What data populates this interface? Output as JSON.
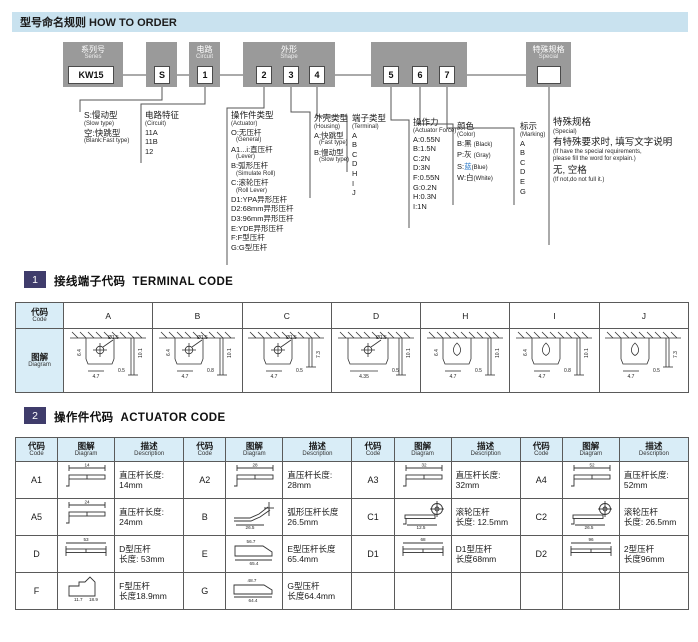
{
  "page": {
    "title": "型号命名规则 HOW TO ORDER"
  },
  "colors": {
    "header_bg": "#c9e2ef",
    "box_gray": "#9a9a9a",
    "table_header_bg": "#d9edf7",
    "badge_bg": "#3f3c6b",
    "line_color": "#555555",
    "blue": "#2878c8"
  },
  "flow": {
    "groups": [
      {
        "key": "series",
        "label_cn": "系列号",
        "label_en": "Series",
        "codes": [
          "KW15"
        ]
      },
      {
        "key": "speed",
        "label_cn": "",
        "label_en": "",
        "codes": [
          "S"
        ]
      },
      {
        "key": "circuit",
        "label_cn": "电路",
        "label_en": "Circuit",
        "codes": [
          "1"
        ]
      },
      {
        "key": "shape",
        "label_cn": "外形",
        "label_en": "Shape",
        "codes": [
          "2",
          "3",
          "4"
        ]
      },
      {
        "key": "force",
        "label_cn": "",
        "label_en": "",
        "codes": [
          "5",
          "6",
          "7"
        ]
      },
      {
        "key": "special",
        "label_cn": "特殊规格",
        "label_en": "Special",
        "codes": [
          ""
        ]
      }
    ],
    "spec_columns": [
      {
        "name": "speed-type",
        "lines": [
          {
            "t": "S:慢动型",
            "s": "cn"
          },
          {
            "t": "(Slow type)",
            "s": "en"
          },
          {
            "t": "空:快跳型",
            "s": "cn"
          },
          {
            "t": "(Blank:Fast type)",
            "s": "en"
          }
        ]
      },
      {
        "name": "circuit-feature",
        "lines": [
          {
            "t": "电路特征",
            "s": "cn"
          },
          {
            "t": "(Circuit)",
            "s": "en"
          },
          {
            "t": "11A",
            "s": "item"
          },
          {
            "t": "11B",
            "s": "item"
          },
          {
            "t": "12",
            "s": "item"
          }
        ]
      },
      {
        "name": "actuator-type",
        "lines": [
          {
            "t": "操作件类型",
            "s": "cn"
          },
          {
            "t": "(Actuator)",
            "s": "en"
          },
          {
            "t": "O:无压杆",
            "s": "item"
          },
          {
            "t": "(General)",
            "s": "en-ind"
          },
          {
            "t": "A1...i:直压杆",
            "s": "item"
          },
          {
            "t": "(Lever)",
            "s": "en-ind"
          },
          {
            "t": "B:弧形压杆",
            "s": "item"
          },
          {
            "t": "(Simulate Roll)",
            "s": "en-ind"
          },
          {
            "t": "C:滚轮压杆",
            "s": "item"
          },
          {
            "t": "(Roll Lever)",
            "s": "en-ind"
          },
          {
            "t": "D1:YPA异形压杆",
            "s": "item"
          },
          {
            "t": "D2:68mm异形压杆",
            "s": "item"
          },
          {
            "t": "D3:96mm异形压杆",
            "s": "item"
          },
          {
            "t": "E:YDE异形压杆",
            "s": "item"
          },
          {
            "t": "F:F型压杆",
            "s": "item"
          },
          {
            "t": "G:G型压杆",
            "s": "item"
          }
        ]
      },
      {
        "name": "housing-type",
        "lines": [
          {
            "t": "外壳类型",
            "s": "cn"
          },
          {
            "t": "(Housing)",
            "s": "en"
          },
          {
            "t": "A:快跳型",
            "s": "item"
          },
          {
            "t": "(Fast type)",
            "s": "en-ind"
          },
          {
            "t": "B:慢动型",
            "s": "item"
          },
          {
            "t": "(Slow type)",
            "s": "en-ind"
          }
        ]
      },
      {
        "name": "terminal-type",
        "lines": [
          {
            "t": "端子类型",
            "s": "cn"
          },
          {
            "t": "(Terminal)",
            "s": "en"
          },
          {
            "t": "A",
            "s": "item"
          },
          {
            "t": "B",
            "s": "item"
          },
          {
            "t": "C",
            "s": "item"
          },
          {
            "t": "D",
            "s": "item"
          },
          {
            "t": "H",
            "s": "item"
          },
          {
            "t": "I",
            "s": "item"
          },
          {
            "t": "J",
            "s": "item"
          }
        ]
      },
      {
        "name": "actuator-force",
        "lines": [
          {
            "t": "操作力",
            "s": "cn"
          },
          {
            "t": "(Actuator Force)",
            "s": "en"
          },
          {
            "t": "A:0.55N",
            "s": "item"
          },
          {
            "t": "B:1.5N",
            "s": "item"
          },
          {
            "t": "C:2N",
            "s": "item"
          },
          {
            "t": "D:3N",
            "s": "item"
          },
          {
            "t": "F:0.55N",
            "s": "item"
          },
          {
            "t": "G:0.2N",
            "s": "item"
          },
          {
            "t": "H:0.3N",
            "s": "item"
          },
          {
            "t": "I:1N",
            "s": "item"
          }
        ]
      },
      {
        "name": "color",
        "lines": [
          {
            "t": "颜色",
            "s": "cn"
          },
          {
            "t": "(Color)",
            "s": "en"
          },
          {
            "seg": [
              {
                "t": "B:黑 "
              },
              {
                "t": "(Black)",
                "small": true
              }
            ],
            "s": "item"
          },
          {
            "seg": [
              {
                "t": "P:灰 "
              },
              {
                "t": "(Gray)",
                "small": true
              }
            ],
            "s": "item"
          },
          {
            "seg": [
              {
                "t": "S:"
              },
              {
                "t": "蓝",
                "c": "blue"
              },
              {
                "t": "(Blue)",
                "small": true
              }
            ],
            "s": "item"
          },
          {
            "seg": [
              {
                "t": "W:白"
              },
              {
                "t": "(White)",
                "small": true
              }
            ],
            "s": "item"
          }
        ]
      },
      {
        "name": "marking",
        "lines": [
          {
            "t": "标示",
            "s": "cn"
          },
          {
            "t": "(Marking)",
            "s": "en"
          },
          {
            "t": "A",
            "s": "item"
          },
          {
            "t": "B",
            "s": "item"
          },
          {
            "t": "C",
            "s": "item"
          },
          {
            "t": "D",
            "s": "item"
          },
          {
            "t": "E",
            "s": "item"
          },
          {
            "t": "G",
            "s": "item"
          }
        ]
      },
      {
        "name": "special-spec",
        "lines": [
          {
            "t": "特殊规格",
            "s": "cn2"
          },
          {
            "t": "(Special)",
            "s": "en"
          },
          {
            "t": "有特殊要求时, 填写文字说明",
            "s": "cn2"
          },
          {
            "t": "(If have the special requirements,",
            "s": "en"
          },
          {
            "t": "please fill the word for explain.)",
            "s": "en"
          },
          {
            "t": "无, 空格",
            "s": "cn2"
          },
          {
            "t": "(If not,do not full it.)",
            "s": "en"
          }
        ]
      }
    ]
  },
  "terminal": {
    "number": "1",
    "title_cn": "接线端子代码",
    "title_en": "TERMINAL CODE",
    "code_header_cn": "代码",
    "code_header_en": "Code",
    "diagram_header_cn": "图解",
    "diagram_header_en": "Diagram",
    "columns": [
      {
        "code": "A",
        "hole_type": "cross",
        "wide": false,
        "dims": {
          "left": "6.4",
          "bottom": "4.7",
          "hole": "Ø1.5",
          "gap": "0.5",
          "side": "10.1"
        }
      },
      {
        "code": "B",
        "hole_type": "cross",
        "wide": false,
        "dims": {
          "left": "6.4",
          "bottom": "4.7",
          "hole": "Ø1.5",
          "gap": "0.8",
          "side": "10.1"
        }
      },
      {
        "code": "C",
        "hole_type": "cross",
        "wide": false,
        "dims": {
          "left": "",
          "bottom": "4.7",
          "hole": "Ø1.5",
          "gap": "0.5",
          "side": "7.3"
        }
      },
      {
        "code": "D",
        "hole_type": "cross",
        "wide": true,
        "dims": {
          "left": "",
          "bottom": "4.35",
          "hole": "Ø1.5",
          "gap": "0.5",
          "side": "10.1"
        }
      },
      {
        "code": "H",
        "hole_type": "keyhole",
        "wide": false,
        "dims": {
          "left": "6.4",
          "bottom": "4.7",
          "hole": "",
          "gap": "0.5",
          "side": "10.1"
        }
      },
      {
        "code": "I",
        "hole_type": "keyhole",
        "wide": false,
        "dims": {
          "left": "6.4",
          "bottom": "4.7",
          "hole": "",
          "gap": "0.8",
          "side": "10.1"
        }
      },
      {
        "code": "J",
        "hole_type": "keyhole",
        "wide": false,
        "dims": {
          "left": "",
          "bottom": "4.7",
          "hole": "",
          "gap": "0.5",
          "side": "7.3"
        }
      }
    ]
  },
  "actuator": {
    "number": "2",
    "title_cn": "操作件代码",
    "title_en": "ACTUATOR CODE",
    "headers": {
      "code_cn": "代码",
      "code_en": "Code",
      "diagram_cn": "图解",
      "diagram_en": "Diagram",
      "desc_cn": "描述",
      "desc_en": "Description"
    },
    "rows": [
      [
        {
          "code": "A1",
          "glyph": "lever",
          "dims": [
            "14"
          ],
          "desc": [
            "直压杆长度:",
            "14mm"
          ]
        },
        {
          "code": "A2",
          "glyph": "lever",
          "dims": [
            "28"
          ],
          "desc": [
            "直压杆长度:",
            "28mm"
          ]
        },
        {
          "code": "A3",
          "glyph": "lever",
          "dims": [
            "32"
          ],
          "desc": [
            "直压杆长度:",
            "32mm"
          ]
        },
        {
          "code": "A4",
          "glyph": "lever",
          "dims": [
            "52"
          ],
          "desc": [
            "直压杆长度:",
            "52mm"
          ]
        }
      ],
      [
        {
          "code": "A5",
          "glyph": "lever",
          "dims": [
            "24"
          ],
          "desc": [
            "直压杆长度:",
            "24mm"
          ]
        },
        {
          "code": "B",
          "glyph": "arc",
          "dims": [
            "26.5"
          ],
          "desc": [
            "弧形压杆长度",
            "26.5mm"
          ]
        },
        {
          "code": "C1",
          "glyph": "roller",
          "dims": [
            "12.5"
          ],
          "desc": [
            "滚轮压杆",
            "长度: 12.5mm"
          ]
        },
        {
          "code": "C2",
          "glyph": "roller",
          "dims": [
            "26.5"
          ],
          "desc": [
            "滚轮压杆",
            "长度: 26.5mm"
          ]
        }
      ],
      [
        {
          "code": "D",
          "glyph": "bar",
          "dims": [
            "53"
          ],
          "desc": [
            "D型压杆",
            "长度: 53mm"
          ]
        },
        {
          "code": "E",
          "glyph": "eshape",
          "dims": [
            "56.7",
            "65.4"
          ],
          "desc": [
            "E型压杆长度",
            "65.4mm"
          ]
        },
        {
          "code": "D1",
          "glyph": "bar",
          "dims": [
            "68"
          ],
          "desc": [
            "D1型压杆",
            "长度68mm"
          ]
        },
        {
          "code": "D2",
          "glyph": "bar",
          "dims": [
            "96"
          ],
          "desc": [
            "2型压杆",
            "长度96mm"
          ]
        }
      ],
      [
        {
          "code": "F",
          "glyph": "fshape",
          "dims": [
            "11.7",
            "18.9"
          ],
          "desc": [
            "F型压杆",
            "长度18.9mm"
          ]
        },
        {
          "code": "G",
          "glyph": "gshape",
          "dims": [
            "48.7",
            "64.4"
          ],
          "desc": [
            "G型压杆",
            "长度64.4mm"
          ]
        },
        null,
        null
      ]
    ]
  }
}
